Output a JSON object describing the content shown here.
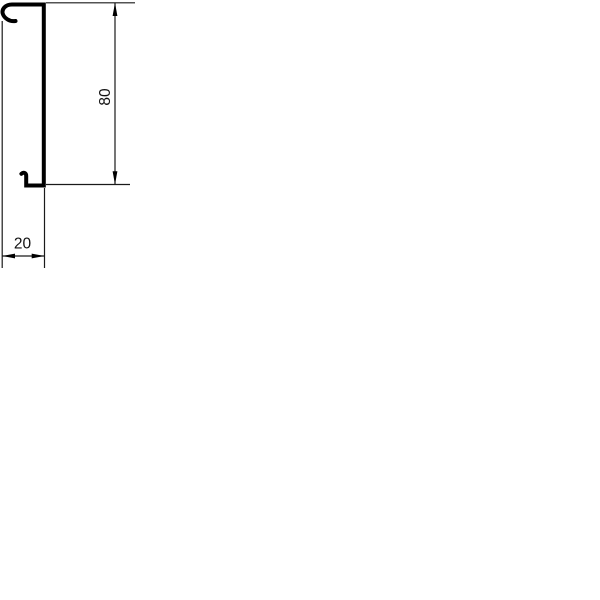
{
  "drawing": {
    "type": "technical-dimension-drawing",
    "subject": "trunking-profile-cross-section-side-view",
    "background_color": "#ffffff",
    "line_color": "#000000",
    "dimensions": {
      "height": {
        "label": "80",
        "orientation": "vertical"
      },
      "depth": {
        "label": "20",
        "orientation": "horizontal"
      }
    }
  }
}
